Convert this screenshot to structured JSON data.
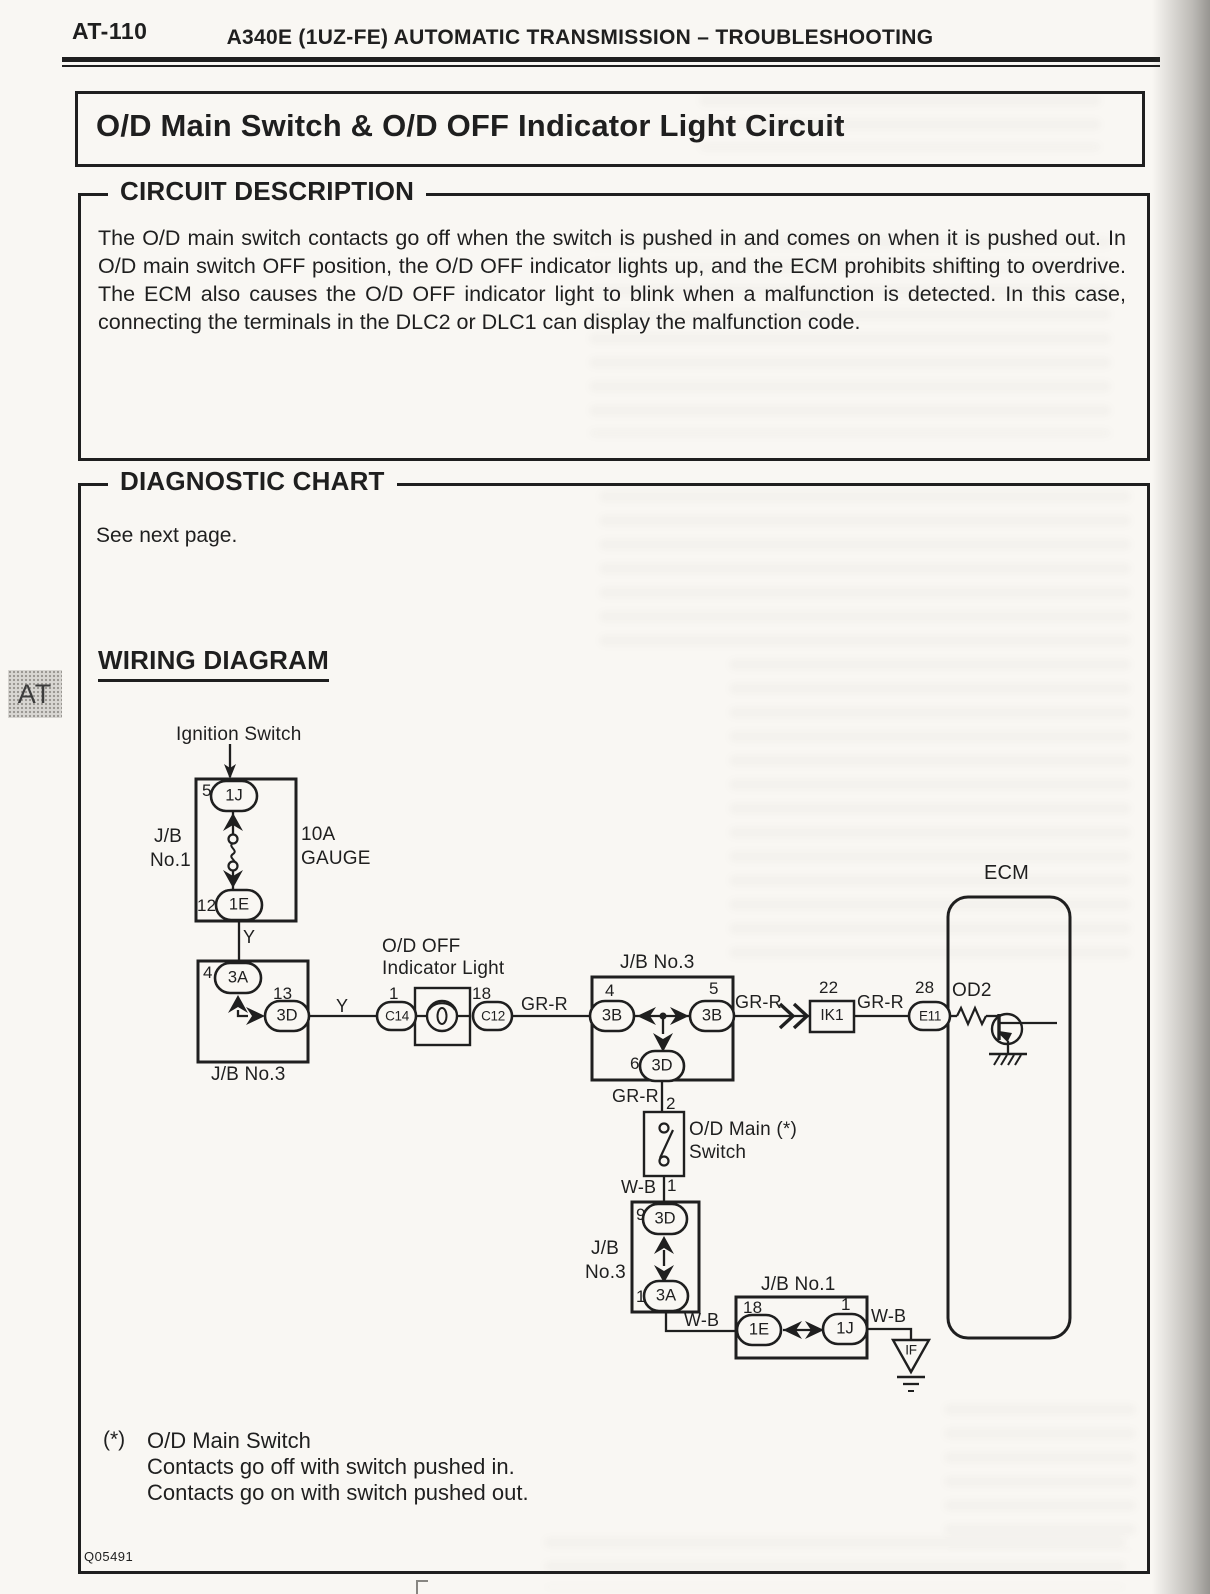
{
  "page": {
    "code": "AT-110",
    "header_title": "A340E (1UZ-FE) AUTOMATIC TRANSMISSION – TROUBLESHOOTING",
    "side_tab": "AT",
    "figure_code": "Q05491"
  },
  "title_box": {
    "title": "O/D Main Switch & O/D OFF Indicator Light Circuit"
  },
  "circuit_description": {
    "heading": "CIRCUIT DESCRIPTION",
    "body": "The O/D main switch contacts go off when the switch is pushed in and comes on when it is pushed out. In O/D main switch OFF position, the O/D OFF indicator lights up, and the ECM prohibits shifting to overdrive. The ECM also causes the O/D OFF indicator light to blink when a malfunction is detected. In this case, connecting the terminals in the DLC2 or DLC1 can display the malfunction code."
  },
  "diagnostic_chart": {
    "heading": "DIAGNOSTIC CHART",
    "note": "See next page."
  },
  "wiring": {
    "heading": "WIRING DIAGRAM",
    "ignition_switch_label": "Ignition Switch",
    "jb1_upper": {
      "name_line1": "J/B",
      "name_line2": "No.1",
      "fuse_line1": "10A",
      "fuse_line2": "GAUGE",
      "pin_top_no": "5",
      "pin_top": "1J",
      "pin_bottom_no": "12",
      "pin_bottom": "1E"
    },
    "wire_y_upper": "Y",
    "jb3_upper": {
      "name": "J/B No.3",
      "pin_top_no": "4",
      "pin_top": "3A",
      "pin_right_no": "13",
      "pin_right": "3D"
    },
    "wire_y_lower": "Y",
    "indicator_light": {
      "name_line1": "O/D OFF",
      "name_line2": "Indicator Light",
      "pin_left_no": "1",
      "pin_left": "C14",
      "pin_right_no": "18",
      "pin_right": "C12"
    },
    "wire_grr_1": "GR-R",
    "jb3_middle": {
      "name": "J/B No.3",
      "pin_left_no": "4",
      "pin_left": "3B",
      "pin_right_no": "5",
      "pin_right": "3B",
      "pin_bottom_no": "6",
      "pin_bottom": "3D"
    },
    "wire_grr_2": "GR-R",
    "ik1": {
      "pin_no": "22",
      "name": "IK1"
    },
    "wire_grr_3": "GR-R",
    "ecm": {
      "name": "ECM",
      "pin_no": "28",
      "pin": "E11",
      "signal": "OD2"
    },
    "wire_grr_4": "GR-R",
    "main_switch": {
      "pin_top_no": "2",
      "name_line1": "O/D Main (*)",
      "name_line2": "Switch",
      "pin_bottom_no": "1",
      "wire_wb": "W-B"
    },
    "jb3_lower": {
      "name_line1": "J/B",
      "name_line2": "No.3",
      "pin_top_no": "9",
      "pin_top": "3D",
      "pin_bottom_no": "1",
      "pin_bottom": "3A"
    },
    "wire_wb_2": "W-B",
    "jb1_lower": {
      "name": "J/B No.1",
      "pin_left_no": "18",
      "pin_left": "1E",
      "pin_right_no": "1",
      "pin_right": "1J",
      "wire_wb": "W-B"
    },
    "if_connector": "IF"
  },
  "footnote": {
    "marker": "(*)",
    "line1": "O/D Main Switch",
    "line2": "Contacts go off with switch pushed in.",
    "line3": "Contacts go on with switch pushed out."
  },
  "colors": {
    "ink": "#1f1f1f",
    "paper": "#f9f7f3"
  }
}
